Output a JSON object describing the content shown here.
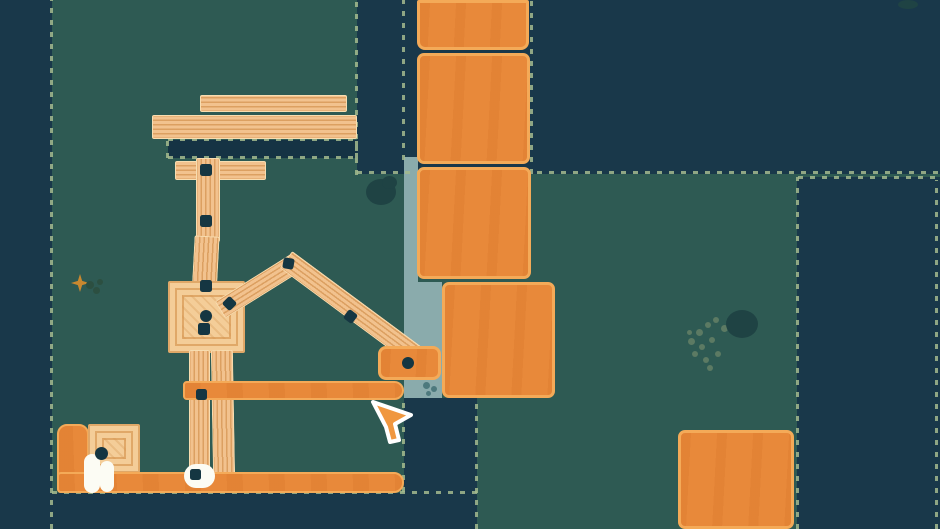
{
  "app": {
    "title": "physics-builder-game-scene"
  },
  "palette": {
    "teal": "#2e5a53",
    "dark": "#19384a",
    "darker": "#153344",
    "light": "#8aabac",
    "stitch": "#a4ba8e",
    "wood": "#f2c28e",
    "woodEdge": "#f8ddb0",
    "woodStripe": "rgba(201,131,60,0.55)",
    "panelBg": "#f4cd98",
    "panelLine": "rgba(214,148,78,0.65)",
    "panelDiag": "rgba(205,136,66,0.25)",
    "blockFill": "#e8893a",
    "blockEdge": "#f4aa58",
    "blockStreak": "rgba(213,116,40,0.28)",
    "bolt": "#153642",
    "white": "#fcfcf4",
    "bush": "#1f4344",
    "lichen": "#5c7a63",
    "leaf": "#2c4f41",
    "stripDot": "#4d797d",
    "sparkle": "#c9882f",
    "cursorFill": "#f0973f",
    "cursorOutline": "#ffffff"
  },
  "scene": {
    "cursor": {
      "x": 368,
      "y": 398
    },
    "sprites": [
      {
        "n": "terrain-left-wall",
        "c": "region-dark",
        "x": 0,
        "y": 0,
        "w": 52,
        "h": 529,
        "i": false
      },
      {
        "n": "terrain-top-band",
        "c": "region-dark",
        "x": 357,
        "y": 0,
        "w": 583,
        "h": 174,
        "i": false
      },
      {
        "n": "terrain-right-wall",
        "c": "region-dark",
        "x": 797,
        "y": 177,
        "w": 143,
        "h": 352,
        "i": false
      },
      {
        "n": "terrain-bottom-floor",
        "c": "region-dark",
        "x": 52,
        "y": 493,
        "w": 352,
        "h": 36,
        "i": false
      },
      {
        "n": "terrain-bottom-notch",
        "c": "region-dark",
        "x": 404,
        "y": 398,
        "w": 73,
        "h": 131,
        "i": false
      },
      {
        "n": "water-channel-upper",
        "c": "region-light",
        "x": 404,
        "y": 157,
        "w": 14,
        "h": 126,
        "i": false
      },
      {
        "n": "water-channel-lower",
        "c": "region-light",
        "x": 404,
        "y": 282,
        "w": 38,
        "h": 116,
        "i": false
      },
      {
        "n": "fixed-platform",
        "c": "region-platform",
        "x": 168,
        "y": 140,
        "w": 189,
        "h": 18,
        "i": false
      },
      {
        "n": "stitch-border",
        "c": "stitch-v",
        "x": 50,
        "y": 0,
        "w": 3,
        "h": 529,
        "i": false
      },
      {
        "n": "stitch-border",
        "c": "stitch-v",
        "x": 355,
        "y": 0,
        "w": 3,
        "h": 175,
        "i": false
      },
      {
        "n": "stitch-border",
        "c": "stitch-v",
        "x": 402,
        "y": 0,
        "w": 3,
        "h": 160,
        "i": false
      },
      {
        "n": "stitch-border",
        "c": "stitch-v",
        "x": 530,
        "y": 0,
        "w": 3,
        "h": 174,
        "i": false
      },
      {
        "n": "stitch-border",
        "c": "stitch-h",
        "x": 357,
        "y": 171,
        "w": 583,
        "h": 3,
        "i": false
      },
      {
        "n": "stitch-border",
        "c": "stitch-h",
        "x": 798,
        "y": 176,
        "w": 142,
        "h": 3,
        "i": false
      },
      {
        "n": "stitch-border",
        "c": "stitch-v",
        "x": 796,
        "y": 177,
        "w": 3,
        "h": 352,
        "i": false
      },
      {
        "n": "stitch-border",
        "c": "stitch-v",
        "x": 935,
        "y": 180,
        "w": 3,
        "h": 349,
        "i": false
      },
      {
        "n": "stitch-border",
        "c": "stitch-h",
        "x": 52,
        "y": 491,
        "w": 425,
        "h": 3,
        "i": false
      },
      {
        "n": "stitch-border",
        "c": "stitch-v",
        "x": 402,
        "y": 398,
        "w": 3,
        "h": 94,
        "i": false
      },
      {
        "n": "stitch-border",
        "c": "stitch-v",
        "x": 475,
        "y": 398,
        "w": 3,
        "h": 131,
        "i": false
      },
      {
        "n": "stitch-border",
        "c": "stitch-h",
        "x": 168,
        "y": 138,
        "w": 189,
        "h": 3,
        "i": false
      },
      {
        "n": "stitch-border",
        "c": "stitch-h",
        "x": 168,
        "y": 156,
        "w": 189,
        "h": 3,
        "i": false
      },
      {
        "n": "stitch-border",
        "c": "stitch-v",
        "x": 166,
        "y": 139,
        "w": 3,
        "h": 19,
        "i": false
      },
      {
        "n": "stitch-border",
        "c": "stitch-v",
        "x": 355,
        "y": 139,
        "w": 3,
        "h": 19,
        "i": false
      },
      {
        "n": "plank-top-upper",
        "c": "plank grain-h",
        "x": 200,
        "y": 95,
        "w": 147,
        "h": 17,
        "i": true
      },
      {
        "n": "plank-top-lower",
        "c": "plank grain-h",
        "x": 152,
        "y": 115,
        "w": 205,
        "h": 24,
        "i": true
      },
      {
        "n": "plank-horizontal",
        "c": "plank grain-h",
        "x": 175,
        "y": 161,
        "w": 91,
        "h": 19,
        "i": true
      },
      {
        "n": "plank-vertical-1",
        "c": "plank grain-v",
        "x": 196,
        "y": 158,
        "w": 24,
        "h": 84,
        "i": true
      },
      {
        "n": "plank-vertical-2",
        "c": "plank grain-v",
        "x": 193,
        "y": 236,
        "w": 25,
        "h": 62,
        "r": 3,
        "i": true
      },
      {
        "n": "wood-panel",
        "c": "panel",
        "x": 168,
        "y": 281,
        "w": 77,
        "h": 72,
        "i": true
      },
      {
        "n": "plank-vertical-3",
        "c": "plank grain-v",
        "x": 189,
        "y": 350,
        "w": 21,
        "h": 126,
        "i": true
      },
      {
        "n": "plank-vertical-4",
        "c": "plank grain-v",
        "x": 212,
        "y": 350,
        "w": 22,
        "h": 128,
        "r": -1,
        "i": true
      },
      {
        "n": "plank-roof-left",
        "c": "plank grain-h",
        "x": 220,
        "y": 300,
        "w": 90,
        "h": 20,
        "r": -32,
        "o": "0 50%",
        "i": true
      },
      {
        "n": "plank-roof-right",
        "c": "plank grain-h",
        "x": 286,
        "y": 249,
        "w": 167,
        "h": 21,
        "r": 36.5,
        "o": "0 50%",
        "i": true
      },
      {
        "n": "orange-beam",
        "c": "orange-piece",
        "x": 183,
        "y": 381,
        "w": 221,
        "h": 19,
        "br": "4px 10px 10px 4px",
        "i": true
      },
      {
        "n": "orange-block-small",
        "c": "block",
        "x": 378,
        "y": 346,
        "w": 63,
        "h": 34,
        "br": "8px",
        "i": true
      },
      {
        "n": "orange-slab",
        "c": "orange-piece",
        "x": 57,
        "y": 424,
        "w": 32,
        "h": 69,
        "br": "10px 10px 4px 4px",
        "i": true
      },
      {
        "n": "wood-panel-floor",
        "c": "panel",
        "x": 88,
        "y": 424,
        "w": 52,
        "h": 49,
        "i": true
      },
      {
        "n": "orange-ground",
        "c": "orange-piece",
        "x": 57,
        "y": 472,
        "w": 347,
        "h": 21,
        "br": "4px 10px 10px 4px",
        "i": true
      },
      {
        "n": "crate",
        "c": "block",
        "x": 417,
        "y": 0,
        "w": 112,
        "h": 50,
        "br": "2px 2px 8px 8px",
        "i": true
      },
      {
        "n": "crate",
        "c": "block",
        "x": 417,
        "y": 53,
        "w": 113,
        "h": 111,
        "i": true
      },
      {
        "n": "crate",
        "c": "block",
        "x": 417,
        "y": 167,
        "w": 114,
        "h": 112,
        "i": true
      },
      {
        "n": "crate",
        "c": "block",
        "x": 442,
        "y": 282,
        "w": 113,
        "h": 116,
        "i": true
      },
      {
        "n": "crate",
        "c": "block",
        "x": 678,
        "y": 430,
        "w": 116,
        "h": 99,
        "i": true
      },
      {
        "n": "joint-bolt",
        "c": "bolt-sq",
        "x": 200,
        "y": 164,
        "w": 12,
        "h": 12,
        "i": true
      },
      {
        "n": "joint-bolt",
        "c": "bolt-sq",
        "x": 200,
        "y": 215,
        "w": 12,
        "h": 12,
        "i": true
      },
      {
        "n": "joint-bolt",
        "c": "bolt-sq",
        "x": 200,
        "y": 280,
        "w": 12,
        "h": 12,
        "i": true
      },
      {
        "n": "joint-bolt",
        "c": "bolt-sq",
        "x": 224,
        "y": 298,
        "w": 11,
        "h": 11,
        "r": 45,
        "i": true
      },
      {
        "n": "joint-bolt",
        "c": "bolt-circle",
        "x": 200,
        "y": 310,
        "w": 12,
        "h": 12,
        "i": true
      },
      {
        "n": "joint-bolt",
        "c": "bolt-sq",
        "x": 198,
        "y": 323,
        "w": 12,
        "h": 12,
        "i": true
      },
      {
        "n": "joint-bolt",
        "c": "bolt-sq",
        "x": 283,
        "y": 258,
        "w": 11,
        "h": 11,
        "r": 10,
        "i": true
      },
      {
        "n": "joint-bolt",
        "c": "bolt-sq",
        "x": 345,
        "y": 311,
        "w": 11,
        "h": 11,
        "r": 37,
        "i": true
      },
      {
        "n": "joint-bolt",
        "c": "bolt-circle",
        "x": 402,
        "y": 357,
        "w": 12,
        "h": 12,
        "i": true
      },
      {
        "n": "joint-bolt",
        "c": "bolt-sq",
        "x": 196,
        "y": 389,
        "w": 11,
        "h": 11,
        "i": true
      },
      {
        "n": "white-blob",
        "c": "blob",
        "x": 184,
        "y": 464,
        "w": 31,
        "h": 24,
        "i": false
      },
      {
        "n": "joint-bolt",
        "c": "bolt-sq",
        "x": 190,
        "y": 469,
        "w": 11,
        "h": 11,
        "i": true
      },
      {
        "n": "egg-left",
        "c": "egg",
        "x": 84,
        "y": 454,
        "w": 16,
        "h": 39,
        "i": false
      },
      {
        "n": "egg-right",
        "c": "egg",
        "x": 100,
        "y": 461,
        "w": 14,
        "h": 31,
        "i": false
      },
      {
        "n": "creature-head",
        "c": "head-dot",
        "x": 95,
        "y": 447,
        "w": 13,
        "h": 13,
        "i": false
      },
      {
        "n": "bush",
        "c": "bush",
        "x": 366,
        "y": 179,
        "w": 30,
        "h": 26,
        "i": false
      },
      {
        "n": "bush",
        "c": "bush",
        "x": 382,
        "y": 176,
        "w": 15,
        "h": 13,
        "i": false
      },
      {
        "n": "sparkle",
        "c": "sparkle",
        "x": 71,
        "y": 274,
        "w": 18,
        "h": 18,
        "i": false
      },
      {
        "n": "leaf-dot",
        "c": "dot dot-leaf",
        "x": 86,
        "y": 281,
        "w": 8,
        "h": 8,
        "i": false
      },
      {
        "n": "leaf-dot",
        "c": "dot dot-leaf",
        "x": 93,
        "y": 287,
        "w": 7,
        "h": 7,
        "i": false
      },
      {
        "n": "leaf-dot",
        "c": "dot dot-leaf",
        "x": 97,
        "y": 279,
        "w": 6,
        "h": 6,
        "i": false
      },
      {
        "n": "lichen-dot",
        "c": "dot dot-lichen",
        "x": 688,
        "y": 338,
        "w": 7,
        "h": 7,
        "i": false
      },
      {
        "n": "lichen-dot",
        "c": "dot dot-lichen",
        "x": 696,
        "y": 329,
        "w": 7,
        "h": 7,
        "i": false
      },
      {
        "n": "lichen-dot",
        "c": "dot dot-lichen",
        "x": 705,
        "y": 322,
        "w": 6,
        "h": 6,
        "i": false
      },
      {
        "n": "lichen-dot",
        "c": "dot dot-lichen",
        "x": 713,
        "y": 317,
        "w": 6,
        "h": 6,
        "i": false
      },
      {
        "n": "lichen-dot",
        "c": "dot dot-lichen",
        "x": 721,
        "y": 325,
        "w": 7,
        "h": 7,
        "i": false
      },
      {
        "n": "lichen-dot",
        "c": "dot dot-lichen",
        "x": 699,
        "y": 344,
        "w": 6,
        "h": 6,
        "i": false
      },
      {
        "n": "lichen-dot",
        "c": "dot dot-lichen",
        "x": 709,
        "y": 337,
        "w": 6,
        "h": 6,
        "i": false
      },
      {
        "n": "lichen-dot",
        "c": "dot dot-lichen",
        "x": 692,
        "y": 351,
        "w": 6,
        "h": 6,
        "i": false
      },
      {
        "n": "lichen-dot",
        "c": "dot dot-lichen",
        "x": 703,
        "y": 357,
        "w": 6,
        "h": 6,
        "i": false
      },
      {
        "n": "lichen-dot",
        "c": "dot dot-lichen",
        "x": 715,
        "y": 351,
        "w": 6,
        "h": 6,
        "i": false
      },
      {
        "n": "lichen-dot",
        "c": "dot dot-lichen",
        "x": 707,
        "y": 365,
        "w": 6,
        "h": 6,
        "i": false
      },
      {
        "n": "lichen-dot",
        "c": "dot dot-lichen",
        "x": 687,
        "y": 330,
        "w": 5,
        "h": 5,
        "i": false
      },
      {
        "n": "bush",
        "c": "bush",
        "x": 726,
        "y": 310,
        "w": 32,
        "h": 28,
        "i": false
      },
      {
        "n": "bush",
        "c": "bush",
        "x": 898,
        "y": 0,
        "w": 20,
        "h": 9,
        "i": false
      },
      {
        "n": "teal-dot",
        "c": "dot dot-teal",
        "x": 423,
        "y": 382,
        "w": 7,
        "h": 7,
        "i": false
      },
      {
        "n": "teal-dot",
        "c": "dot dot-teal",
        "x": 431,
        "y": 386,
        "w": 6,
        "h": 6,
        "i": false
      },
      {
        "n": "teal-dot",
        "c": "dot dot-teal",
        "x": 426,
        "y": 391,
        "w": 5,
        "h": 5,
        "i": false
      }
    ]
  }
}
